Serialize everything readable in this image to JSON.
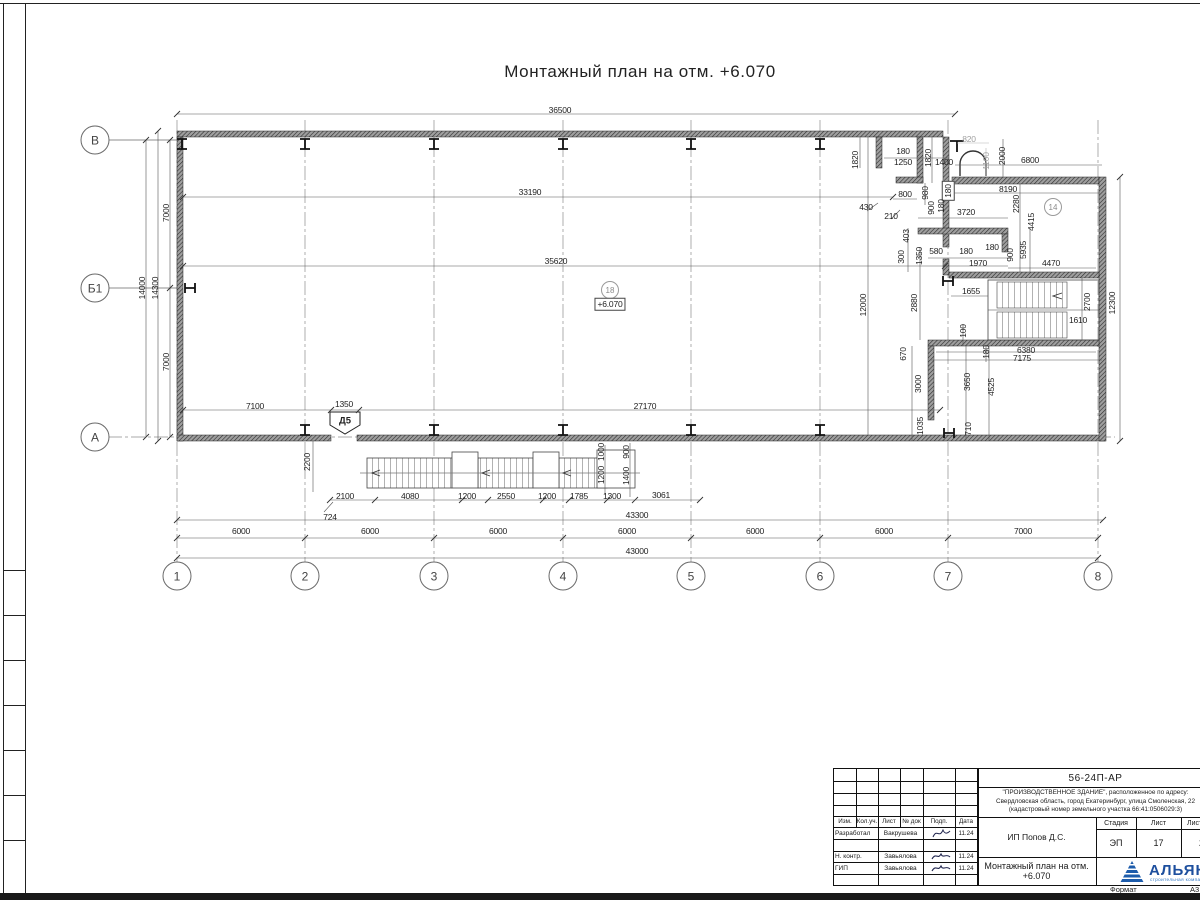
{
  "sheet": {
    "title": "Монтажный план на отм. +6.070"
  },
  "plan": {
    "grid": {
      "cols_y": 576,
      "rows_x": 95,
      "cols": [
        {
          "label": "1",
          "x": 177
        },
        {
          "label": "2",
          "x": 305
        },
        {
          "label": "3",
          "x": 434
        },
        {
          "label": "4",
          "x": 563
        },
        {
          "label": "5",
          "x": 691
        },
        {
          "label": "6",
          "x": 820
        },
        {
          "label": "7",
          "x": 948
        },
        {
          "label": "8",
          "x": 1098
        }
      ],
      "rows": [
        {
          "label": "В",
          "y": 140
        },
        {
          "label": "Б1",
          "y": 288
        },
        {
          "label": "А",
          "y": 437
        }
      ]
    },
    "room_tags": [
      {
        "t": "18",
        "x": 610,
        "y": 290
      },
      {
        "t": "14",
        "x": 1053,
        "y": 207
      }
    ],
    "level_mark": {
      "t": "+6.070",
      "x": 610,
      "y": 304
    },
    "door_tag": {
      "t": "Д5",
      "x": 345,
      "y": 421
    },
    "dim_labels": [
      {
        "t": "36500",
        "x": 560,
        "y": 110
      },
      {
        "t": "33190",
        "x": 530,
        "y": 192
      },
      {
        "t": "35620",
        "x": 556,
        "y": 261
      },
      {
        "t": "12000",
        "x": 863,
        "y": 305,
        "r": 1
      },
      {
        "t": "2880",
        "x": 914,
        "y": 303,
        "r": 1
      },
      {
        "t": "1820",
        "x": 855,
        "y": 160,
        "r": 1
      },
      {
        "t": "180",
        "x": 903,
        "y": 151
      },
      {
        "t": "1250",
        "x": 903,
        "y": 162
      },
      {
        "t": "1820",
        "x": 928,
        "y": 158,
        "r": 1
      },
      {
        "t": "1400",
        "x": 944,
        "y": 162
      },
      {
        "t": "820",
        "x": 969,
        "y": 139,
        "g": 1
      },
      {
        "t": "1100",
        "x": 986,
        "y": 161,
        "r": 1,
        "g": 1
      },
      {
        "t": "2000",
        "x": 1002,
        "y": 156,
        "r": 1
      },
      {
        "t": "6800",
        "x": 1030,
        "y": 160
      },
      {
        "t": "800",
        "x": 905,
        "y": 194
      },
      {
        "t": "980",
        "x": 925,
        "y": 193,
        "r": 1
      },
      {
        "t": "180",
        "x": 948,
        "y": 191,
        "r": 1,
        "b": 1
      },
      {
        "t": "430",
        "x": 866,
        "y": 207
      },
      {
        "t": "210",
        "x": 891,
        "y": 216
      },
      {
        "t": "900",
        "x": 931,
        "y": 208,
        "r": 1
      },
      {
        "t": "180",
        "x": 941,
        "y": 206,
        "r": 1
      },
      {
        "t": "3720",
        "x": 966,
        "y": 212
      },
      {
        "t": "8190",
        "x": 1008,
        "y": 189
      },
      {
        "t": "2280",
        "x": 1016,
        "y": 204,
        "r": 1
      },
      {
        "t": "4415",
        "x": 1031,
        "y": 222,
        "r": 1
      },
      {
        "t": "403",
        "x": 906,
        "y": 236,
        "r": 1
      },
      {
        "t": "300",
        "x": 901,
        "y": 257,
        "r": 1
      },
      {
        "t": "1350",
        "x": 919,
        "y": 256,
        "r": 1
      },
      {
        "t": "580",
        "x": 936,
        "y": 251
      },
      {
        "t": "180",
        "x": 966,
        "y": 251
      },
      {
        "t": "1970",
        "x": 978,
        "y": 263
      },
      {
        "t": "180",
        "x": 992,
        "y": 247
      },
      {
        "t": "900",
        "x": 1010,
        "y": 255,
        "r": 1
      },
      {
        "t": "5935",
        "x": 1023,
        "y": 250,
        "r": 1
      },
      {
        "t": "4470",
        "x": 1051,
        "y": 263
      },
      {
        "t": "1655",
        "x": 971,
        "y": 291
      },
      {
        "t": "2700",
        "x": 1087,
        "y": 302,
        "r": 1
      },
      {
        "t": "1610",
        "x": 1078,
        "y": 320
      },
      {
        "t": "12300",
        "x": 1112,
        "y": 303,
        "r": 1
      },
      {
        "t": "100",
        "x": 963,
        "y": 331,
        "r": 1
      },
      {
        "t": "180",
        "x": 986,
        "y": 352,
        "r": 1
      },
      {
        "t": "6380",
        "x": 1026,
        "y": 350
      },
      {
        "t": "7175",
        "x": 1022,
        "y": 358
      },
      {
        "t": "670",
        "x": 903,
        "y": 354,
        "r": 1
      },
      {
        "t": "3000",
        "x": 918,
        "y": 384,
        "r": 1
      },
      {
        "t": "1035",
        "x": 920,
        "y": 426,
        "r": 1
      },
      {
        "t": "3650",
        "x": 967,
        "y": 382,
        "r": 1
      },
      {
        "t": "4525",
        "x": 991,
        "y": 387,
        "r": 1
      },
      {
        "t": "710",
        "x": 968,
        "y": 429,
        "r": 1
      },
      {
        "t": "7100",
        "x": 255,
        "y": 406
      },
      {
        "t": "1350",
        "x": 344,
        "y": 404
      },
      {
        "t": "27170",
        "x": 645,
        "y": 406
      },
      {
        "t": "2200",
        "x": 307,
        "y": 462,
        "r": 1
      },
      {
        "t": "2100",
        "x": 345,
        "y": 496
      },
      {
        "t": "4080",
        "x": 410,
        "y": 496
      },
      {
        "t": "1200",
        "x": 467,
        "y": 496
      },
      {
        "t": "2550",
        "x": 506,
        "y": 496
      },
      {
        "t": "1200",
        "x": 547,
        "y": 496
      },
      {
        "t": "1785",
        "x": 579,
        "y": 496
      },
      {
        "t": "1300",
        "x": 612,
        "y": 496
      },
      {
        "t": "3061",
        "x": 661,
        "y": 495
      },
      {
        "t": "1000",
        "x": 601,
        "y": 452,
        "r": 1
      },
      {
        "t": "1200",
        "x": 601,
        "y": 475,
        "r": 1
      },
      {
        "t": "900",
        "x": 626,
        "y": 452,
        "r": 1
      },
      {
        "t": "1400",
        "x": 626,
        "y": 476,
        "r": 1
      },
      {
        "t": "724",
        "x": 330,
        "y": 517
      },
      {
        "t": "43300",
        "x": 637,
        "y": 515
      },
      {
        "t": "6000",
        "x": 241,
        "y": 531
      },
      {
        "t": "6000",
        "x": 370,
        "y": 531
      },
      {
        "t": "6000",
        "x": 498,
        "y": 531
      },
      {
        "t": "6000",
        "x": 627,
        "y": 531
      },
      {
        "t": "6000",
        "x": 755,
        "y": 531
      },
      {
        "t": "6000",
        "x": 884,
        "y": 531
      },
      {
        "t": "7000",
        "x": 1023,
        "y": 531
      },
      {
        "t": "43000",
        "x": 637,
        "y": 551
      },
      {
        "t": "7000",
        "x": 166,
        "y": 213,
        "r": 1
      },
      {
        "t": "7000",
        "x": 166,
        "y": 362,
        "r": 1
      },
      {
        "t": "14300",
        "x": 155,
        "y": 288,
        "r": 1
      },
      {
        "t": "14000",
        "x": 142,
        "y": 288,
        "r": 1
      }
    ]
  },
  "titleblock": {
    "doc_number": "56-24П-АР",
    "project_line1": "\"ПРОИЗВОДСТВЕННОЕ ЗДАНИЕ\", расположенное по адресу:",
    "project_line2": "Свердловская область, город Екатеринбург, улица Смоленская, 22",
    "project_line3": "(кадастровый номер земельного участка 66:41:0506029:3)",
    "client": "ИП Попов Д.С.",
    "drawing_title": "Монтажный план на отм. +6.070",
    "col_izm": "Изм.",
    "col_kol": "Кол.уч.",
    "col_list": "Лист",
    "col_doc": "№ док",
    "col_podp": "Подп.",
    "col_data": "Дата",
    "stage_label": "Стадия",
    "sheet_label": "Лист",
    "sheets_label": "Листов",
    "stage": "ЭП",
    "sheet_no": "17",
    "sheets_total": "2",
    "crew": [
      {
        "role": "Разработал",
        "name": "Вакрушева",
        "date": "11.24"
      },
      {
        "role": "Н. контр.",
        "name": "Завьялова",
        "date": "11.24"
      },
      {
        "role": "ГИП",
        "name": "Завьялова",
        "date": "11.24"
      }
    ],
    "format_label": "Формат",
    "format_value": "А3",
    "logo_name": "АЛЬЯНС",
    "logo_subtitle": "строительная компания",
    "logo_color": "#1d4f9e"
  }
}
